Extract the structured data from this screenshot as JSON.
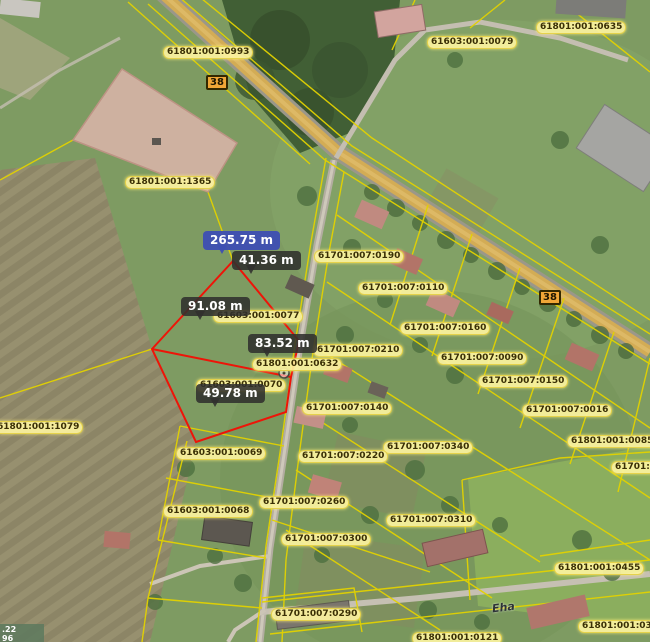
{
  "road_number": "38",
  "street_name": "Eha",
  "coordinate_overlay": {
    "line1": ".22",
    "line2": "96"
  },
  "measurements": {
    "total": "265.75 m",
    "segments": [
      "41.36 m",
      "91.08 m",
      "83.52 m",
      "49.78 m"
    ]
  },
  "parcels": [
    "61801:001:0993",
    "61603:001:0079",
    "61801:001:0635",
    "61801:001:1365",
    "61701:007:0190",
    "61701:007:0110",
    "61701:007:0160",
    "61701:007:0090",
    "61701:007:0150",
    "61701:007:0016",
    "61801:001:0085",
    "61701:00",
    "61701:007:0210",
    "61801:001:0632",
    "61603:001:0077",
    "61603:001:0070",
    "61701:007:0140",
    "61701:007:0340",
    "61701:007:0220",
    "61603:001:0069",
    "61701:007:0260",
    "61701:007:0310",
    "61603:001:0068",
    "61701:007:0300",
    "61701:007:0290",
    "61801:001:0455",
    "61801:001:0371",
    "61801:001:0121",
    "61801:001:1079"
  ],
  "colors": {
    "parcel_line": "#e3d200",
    "selected_parcel_outline": "#ee1408",
    "measure_total_bg": "#3e4fb2",
    "measure_bg": "#30302e",
    "parcel_label_bg": "#fcf3a0",
    "road_badge_bg": "#f0a637",
    "highlight_parcel_fill": "#dcb5ab"
  }
}
